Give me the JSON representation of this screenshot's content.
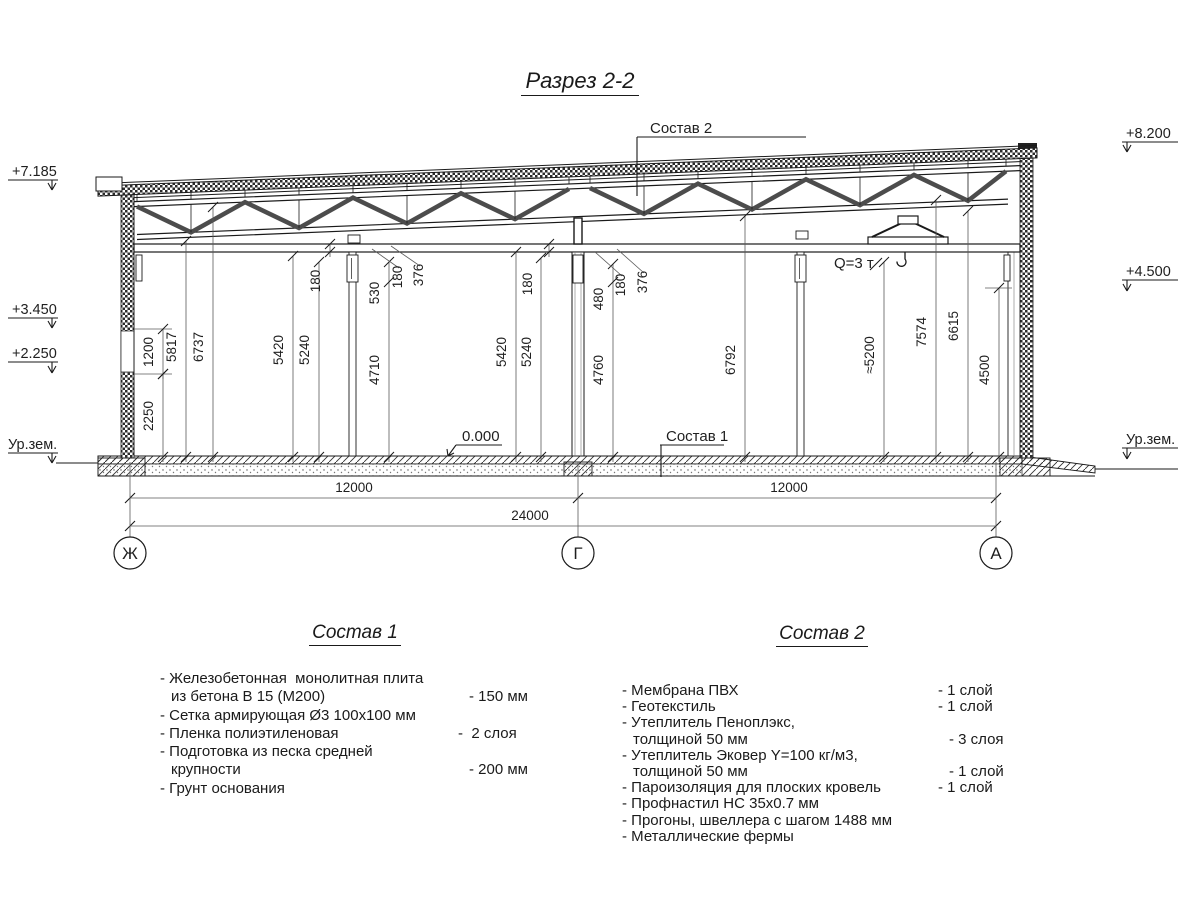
{
  "title": "Разрез 2-2",
  "drawing": {
    "elevations_left": [
      "+7.185",
      "+3.450",
      "+2.250",
      "Ур.зем."
    ],
    "elevations_right": [
      "+8.200",
      "+4.500",
      "Ур.зем."
    ],
    "axes": [
      "Ж",
      "Г",
      "А"
    ],
    "hdims": [
      "12000",
      "12000",
      "24000"
    ],
    "labels": {
      "sostav2": "Состав 2",
      "sostav1": "Состав 1",
      "zero": "0.000",
      "crane": "Q=3 т"
    },
    "vertical_dims": [
      {
        "x": 163,
        "y1": 374,
        "y2": 457,
        "label": "2250",
        "lx": 153,
        "ly": 416
      },
      {
        "x": 163,
        "y1": 329,
        "y2": 374,
        "label": "1200",
        "lx": 153,
        "ly": 352
      },
      {
        "x": 186,
        "y1": 241,
        "y2": 457,
        "label": "5817",
        "lx": 176,
        "ly": 347
      },
      {
        "x": 213,
        "y1": 207,
        "y2": 457,
        "label": "6737",
        "lx": 203,
        "ly": 347
      },
      {
        "x": 293,
        "y1": 256,
        "y2": 457,
        "label": "5420",
        "lx": 283,
        "ly": 350
      },
      {
        "x": 319,
        "y1": 262,
        "y2": 457,
        "label": "5240",
        "lx": 309,
        "ly": 350
      },
      {
        "x": 330,
        "y1": 244,
        "y2": 252,
        "label": "180",
        "lx": 320,
        "ly": 281
      },
      {
        "x": 389,
        "y1": 262,
        "y2": 457,
        "label": "4710",
        "lx": 379,
        "ly": 370,
        "mid_tick": 282,
        "mid_label": "530",
        "mlx": 379,
        "mly": 293
      },
      {
        "x": 516,
        "y1": 252,
        "y2": 457,
        "label": "5420",
        "lx": 506,
        "ly": 352
      },
      {
        "x": 541,
        "y1": 258,
        "y2": 457,
        "label": "5240",
        "lx": 531,
        "ly": 352
      },
      {
        "x": 549,
        "y1": 244,
        "y2": 252,
        "label": "180",
        "lx": 532,
        "ly": 284
      },
      {
        "x": 613,
        "y1": 264,
        "y2": 457,
        "label": "4760",
        "lx": 603,
        "ly": 370,
        "mid_tick": 282,
        "mid_label": "480",
        "mlx": 603,
        "mly": 299
      },
      {
        "x": 745,
        "y1": 216,
        "y2": 457,
        "label": "6792",
        "lx": 735,
        "ly": 360
      },
      {
        "x": 884,
        "y1": 262,
        "y2": 457,
        "label": "≈5200",
        "lx": 874,
        "ly": 355
      },
      {
        "x": 936,
        "y1": 200,
        "y2": 457,
        "label": "7574",
        "lx": 926,
        "ly": 332
      },
      {
        "x": 968,
        "y1": 211,
        "y2": 457,
        "label": "6615",
        "lx": 958,
        "ly": 326
      },
      {
        "x": 999,
        "y1": 288,
        "y2": 457,
        "label": "4500",
        "lx": 989,
        "ly": 370
      }
    ],
    "float_labels": [
      {
        "label": "180",
        "lx": 402,
        "ly": 277,
        "leader": [
          399,
          268,
          372,
          249
        ]
      },
      {
        "label": "376",
        "lx": 423,
        "ly": 275,
        "leader": [
          420,
          266,
          391,
          246
        ]
      },
      {
        "label": "180",
        "lx": 625,
        "ly": 285,
        "leader": [
          622,
          276,
          595,
          252
        ]
      },
      {
        "label": "376",
        "lx": 647,
        "ly": 282,
        "leader": [
          644,
          273,
          617,
          249
        ]
      }
    ],
    "ext_lines": [
      [
        134,
        329,
        172
      ],
      [
        134,
        374,
        172
      ],
      [
        985,
        288,
        1012
      ]
    ]
  },
  "notes": {
    "sostav1": {
      "heading": "Состав 1",
      "lines": [
        {
          "text": "- Железобетонная  монолитная плита",
          "value": "",
          "indent": false
        },
        {
          "text": "из бетона В 15 (М200)",
          "value": "- 150 мм",
          "indent": true
        },
        {
          "text": "- Сетка армирующая Ø3 100x100 мм",
          "value": "",
          "indent": false
        },
        {
          "text": "- Пленка полиэтиленовая",
          "value": "-  2 слоя",
          "indent": false
        },
        {
          "text": "- Подготовка из песка средней",
          "value": "",
          "indent": false
        },
        {
          "text": "крупности",
          "value": "- 200 мм",
          "indent": true
        },
        {
          "text": "- Грунт основания",
          "value": "",
          "indent": false
        }
      ]
    },
    "sostav2": {
      "heading": "Состав 2",
      "lines": [
        {
          "text": "- Мембрана ПВХ",
          "value": "- 1 слой",
          "indent": false
        },
        {
          "text": "- Геотекстиль",
          "value": "- 1 слой",
          "indent": false
        },
        {
          "text": "- Утеплитель Пеноплэкс,",
          "value": "",
          "indent": false
        },
        {
          "text": "толщиной 50 мм",
          "value": "- 3 слоя",
          "indent": true
        },
        {
          "text": "- Утеплитель Эковер Y=100 кг/м3,",
          "value": "",
          "indent": false
        },
        {
          "text": "толщиной 50 мм",
          "value": "- 1 слой",
          "indent": true
        },
        {
          "text": "- Пароизоляция для плоских кровель",
          "value": "- 1 слой",
          "indent": false
        },
        {
          "text": "- Профнастил НС 35x0.7 мм",
          "value": "",
          "indent": false
        },
        {
          "text": "- Прогоны, швеллера с шагом 1488 мм",
          "value": "",
          "indent": false
        },
        {
          "text": "- Металлические фермы",
          "value": "",
          "indent": false
        }
      ]
    }
  }
}
